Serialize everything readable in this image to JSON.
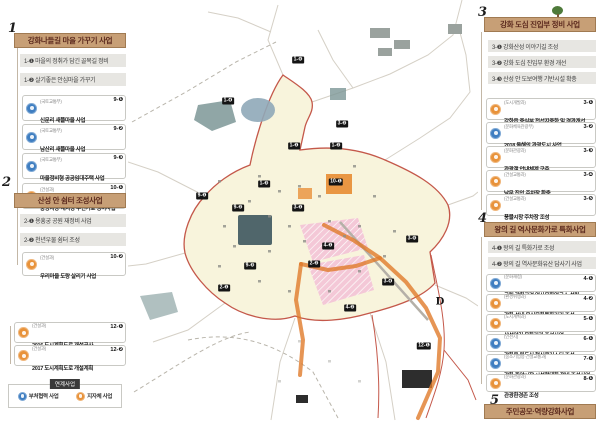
{
  "colors": {
    "header_tan": "#c79f76",
    "ministry_blue": "#3f7ec1",
    "local_orange": "#e8923a",
    "wall_red": "#c4584a",
    "route_orange": "#e07b2a",
    "market_pink": "#f3c3d6",
    "fortress_cream": "#f8f4dc"
  },
  "legend": {
    "tab": "연계사업",
    "items": [
      {
        "label": "부처협력 사업"
      },
      {
        "label": "지자체 사업"
      }
    ]
  },
  "sections": {
    "s1": {
      "num": "1",
      "title": "강화나들길 마을 가꾸기 사업",
      "subs": [
        "1-❶ 마을의 정취가 담긴 골목길 정비",
        "1-❷ 살기좋은 안심마을 가꾸기"
      ],
      "cards": [
        {
          "dept": "(국토교통부)",
          "name": "신문리 새뜰마을 사업",
          "badge": "9-❶"
        },
        {
          "dept": "(국토교통부)",
          "name": "남산리 새뜰마을 사업",
          "badge": "9-❷"
        },
        {
          "dept": "(국토교통부)",
          "name": "마을정비형 공공임대주택 사업",
          "badge": "9-❸"
        },
        {
          "dept": "(건설과)",
          "name": "중앙시장·새시장 주변가로 정비사업",
          "badge": "10-❶"
        }
      ]
    },
    "s2": {
      "num": "2",
      "title": "산성 안 쉼터 조성사업",
      "subs": [
        "2-❶ 용흥궁 공원 재정비 사업",
        "2-❷ 천년우물 쉼터 조성"
      ],
      "cards": [
        {
          "dept": "(건설과)",
          "name": "우리마을 도랑 살리기 사업",
          "badge": "10-❷"
        }
      ]
    },
    "extra": {
      "cards": [
        {
          "dept": "(건설과)",
          "name": "2016 도시계획도로 개설공사",
          "badge": "12-❶"
        },
        {
          "dept": "(건설과)",
          "name": "2017 도시계획도로 개설계획",
          "badge": "12-❷"
        }
      ]
    },
    "s3": {
      "num": "3",
      "title": "강화 도심 진입부 정비 사업",
      "subs": [
        "3-❶ 강화산성 이야기길 조성",
        "3-❷ 강화 도심 진입부 환경 개선",
        "3-❸ 산성 안 도보여행 기반시설 확충"
      ],
      "cards": [
        {
          "dept": "(도시개발과)",
          "name": "강화읍 중심부 전선지중화 및 경관개선",
          "badge": "3-❶"
        },
        {
          "dept": "(문화체육관광부)",
          "name": "2018 올해의 관광도시 사업",
          "badge": "3-❷"
        },
        {
          "dept": "(문화관광과)",
          "name": "관광객 안내체계 구축",
          "badge": "3-❸"
        },
        {
          "dept": "(건설교통과)",
          "name": "남문 진입 주차장 확충",
          "badge": "3-❹"
        },
        {
          "dept": "(건설교통과)",
          "name": "풍물시장 주차장 조성",
          "badge": "3-❺"
        }
      ]
    },
    "s4": {
      "num": "4",
      "title": "왕의 길 역사문화가로 특화사업",
      "subs": [
        "4-❶ 왕의 길 특화가로 조성",
        "4-❷ 왕의 길 역사문화유산 답사기 사업"
      ],
      "cards": [
        {
          "dept": "(문화재청)",
          "name": "국립 강화고려 역사문화연구소 설립",
          "badge": "4-❶"
        },
        {
          "dept": "(환경위생과)",
          "name": "강화 성내 음식문화특화거리 조성",
          "badge": "4-❷"
        },
        {
          "dept": "(도시계획과)",
          "name": "산성안길 문화거리 조성사업",
          "badge": "5-❶"
        },
        {
          "dept": "(인천시)",
          "name": "강화읍 원도심 혁신클러스터 조성",
          "badge": "6-❶"
        },
        {
          "dept": "(중소기업청·건설교통과)",
          "name": "강화 중앙시장 시설현대화 정비 조성사업",
          "badge": "7-❶"
        },
        {
          "dept": "(문화관광과)",
          "name": "관광환경존 조성",
          "badge": "8-❶"
        }
      ]
    },
    "s5": {
      "num": "5",
      "title": "주민공모·역량강화사업"
    }
  },
  "map": {
    "markers": [
      {
        "label": "1-❺",
        "x": 170,
        "y": 60
      },
      {
        "label": "1-❹",
        "x": 100,
        "y": 101
      },
      {
        "label": "3-❷",
        "x": 214,
        "y": 124
      },
      {
        "label": "1-❶",
        "x": 166,
        "y": 146
      },
      {
        "label": "1-❷",
        "x": 208,
        "y": 146
      },
      {
        "label": "1-❸",
        "x": 136,
        "y": 184
      },
      {
        "label": "10-❶",
        "x": 208,
        "y": 182
      },
      {
        "label": "9-❶",
        "x": 74,
        "y": 196
      },
      {
        "label": "9-❷",
        "x": 110,
        "y": 208
      },
      {
        "label": "3-❶",
        "x": 170,
        "y": 208
      },
      {
        "label": "4-❶",
        "x": 200,
        "y": 246
      },
      {
        "label": "3-❺",
        "x": 284,
        "y": 239
      },
      {
        "label": "9-❸",
        "x": 122,
        "y": 266
      },
      {
        "label": "2-❷",
        "x": 186,
        "y": 264
      },
      {
        "label": "2-❶",
        "x": 96,
        "y": 288
      },
      {
        "label": "3-❹",
        "x": 260,
        "y": 282
      },
      {
        "label": "4-❷",
        "x": 222,
        "y": 308
      },
      {
        "label": "12-❶",
        "x": 296,
        "y": 346
      },
      {
        "label": "D",
        "x": 312,
        "y": 302,
        "kind": "letter"
      }
    ]
  }
}
